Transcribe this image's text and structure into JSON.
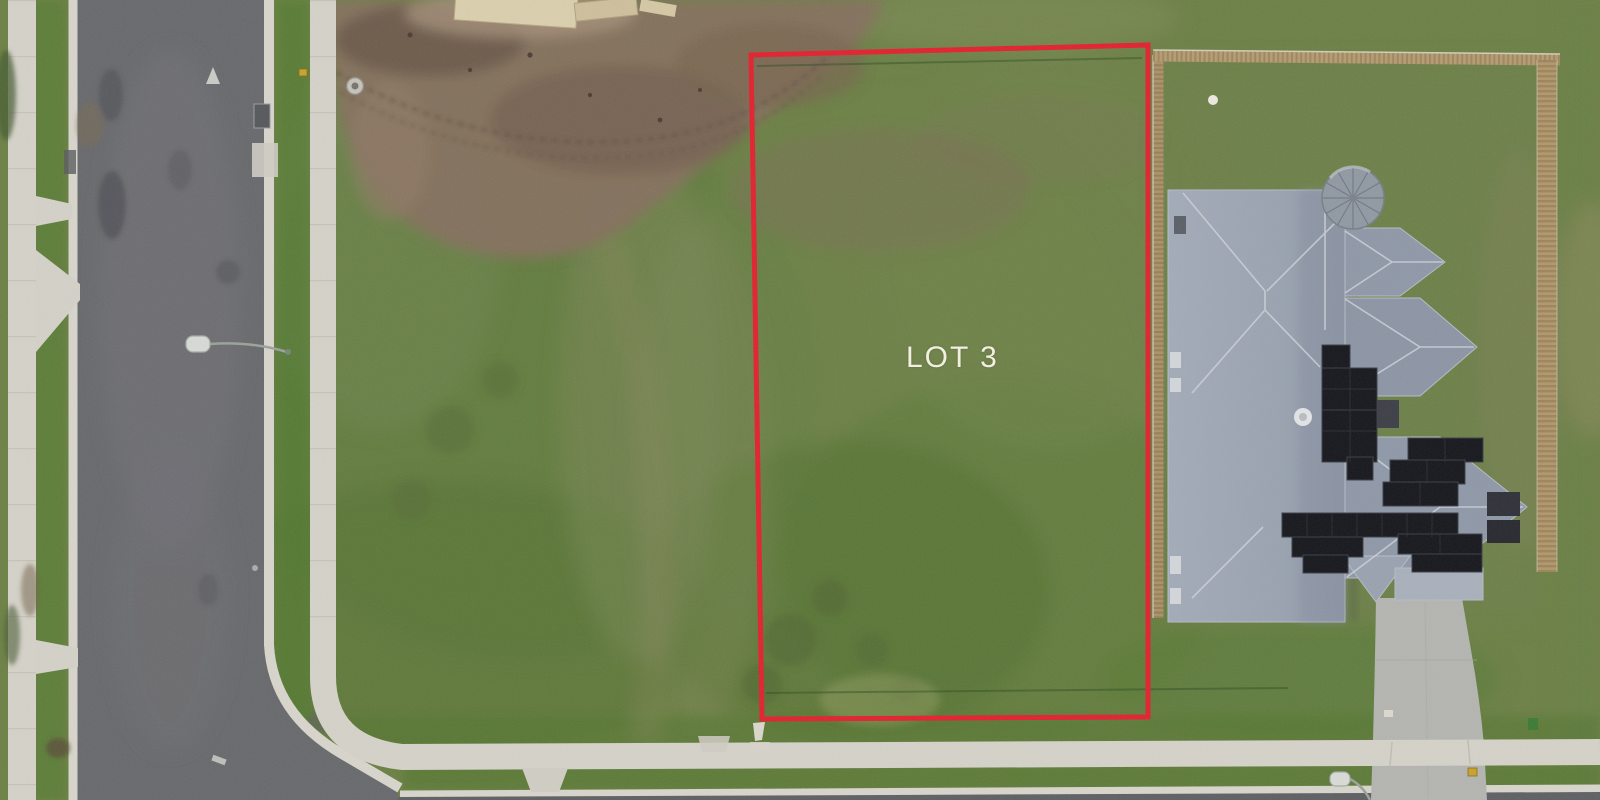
{
  "scene": {
    "description": "Aerial drone photograph of a vacant residential land lot outlined in red, labelled LOT 3, beside an occupied house with rooftop solar panels and timber fences; a corner street with footpaths runs along the left and bottom, with a muddy construction area at the top.",
    "view": "top-down aerial"
  },
  "lot": {
    "label": "LOT 3",
    "boundary_points": "751,55 1148,45 1148,717 762,719",
    "boundary_color": "#e3202e",
    "label_color": "#f2efe1"
  },
  "palette": {
    "grass_base": "#6c8045",
    "grass_vibrant": "#4f782e",
    "grass_olive": "#8a9060",
    "dirt": "#84705e",
    "asphalt": "#68696c",
    "concrete_path": "#d5d2c9",
    "curb": "#d8d5cc",
    "roof_gray": "#98a1af",
    "roof_ridge": "#cdd2d9",
    "solar_panel": "#15161b",
    "fence_timber": "#b1976a",
    "driveway_concrete": "#b4b5b1",
    "water_tank": "#9099a2"
  }
}
